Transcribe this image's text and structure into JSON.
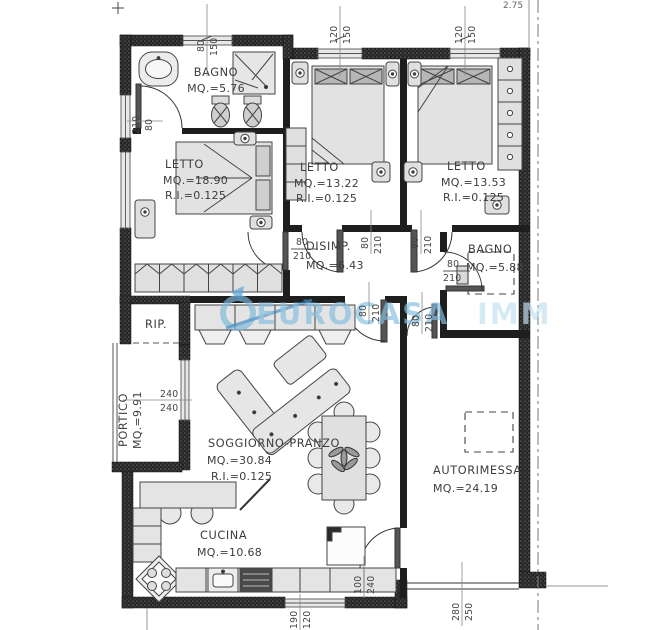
{
  "watermark": {
    "brand": "EUROCASA",
    "brand_suffix": "IMM"
  },
  "elevation": "2.75",
  "rooms": {
    "bagno1": {
      "name": "BAGNO",
      "area": "MQ.=5.76"
    },
    "letto1": {
      "name": "LETTO",
      "area": "MQ.=18.90",
      "ri": "R.I.=0.125"
    },
    "letto2": {
      "name": "LETTO",
      "area": "MQ.=13.22",
      "ri": "R.I.=0.125"
    },
    "letto3": {
      "name": "LETTO",
      "area": "MQ.=13.53",
      "ri": "R.I.=0.125"
    },
    "disimp": {
      "name": "DISIMP.",
      "area": "MQ.=6.43"
    },
    "bagno2": {
      "name": "BAGNO",
      "area": "MQ.=5.88"
    },
    "rip": {
      "name": "RIP."
    },
    "portico": {
      "name": "PORTICO",
      "area": "MQ.=9.91"
    },
    "soggiorno": {
      "name": "SOGGIORNO-PRANZO",
      "area": "MQ.=30.84",
      "ri": "R.I.=0.125"
    },
    "cucina": {
      "name": "CUCINA",
      "area": "MQ.=10.68"
    },
    "autorimessa": {
      "name": "AUTORIMESSA",
      "area": "MQ.=24.19"
    }
  },
  "dims": {
    "bagno1_window": {
      "a": "80",
      "b": "150"
    },
    "letto2_window": {
      "a": "120",
      "b": "150"
    },
    "letto3_window": {
      "a": "120",
      "b": "150"
    },
    "bagno1_door": {
      "a": "210",
      "b": "80"
    },
    "letto1_door": {
      "a": "80",
      "b": "210"
    },
    "letto2_door": {
      "a": "80",
      "b": "210"
    },
    "letto3_door": {
      "a": "80",
      "b": "210"
    },
    "soggiorno_door": {
      "a": "80",
      "b": "210"
    },
    "entry_door": {
      "a": "80",
      "b": "210"
    },
    "bagno2_door": {
      "a": "80",
      "b": "210"
    },
    "portico_window": {
      "a": "240",
      "b": "240"
    },
    "garage_door": {
      "a": "100",
      "b": "240"
    },
    "cucina_window": {
      "a": "190",
      "b": "120"
    },
    "garage_gate": {
      "a": "280",
      "b": "250"
    }
  }
}
